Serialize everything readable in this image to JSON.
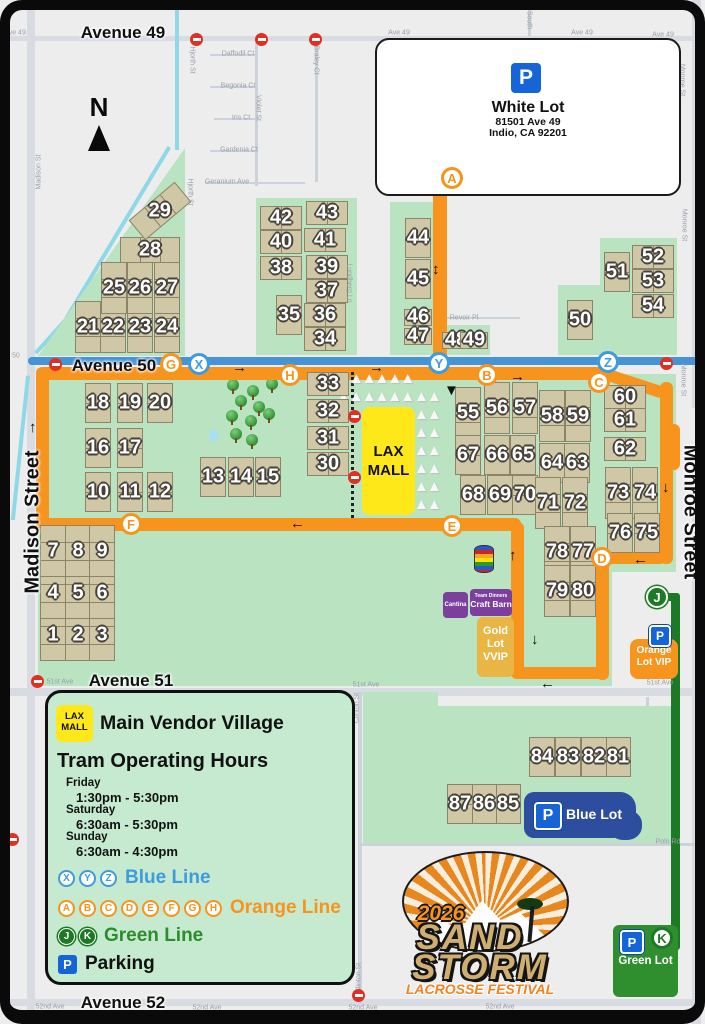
{
  "colors": {
    "blue_line": "#3f9be0",
    "orange_line": "#f7941e",
    "green_line": "#1d7a24",
    "parking_blue": "#1565d8",
    "blue_lot": "#2d4d9e",
    "green_lot": "#2f8f2f",
    "gold_lot": "#e9b545",
    "orange_lot": "#f7941e",
    "purple_venue": "#7d3f9e",
    "field_tan": "#cfc7a6",
    "festival_green": "#b9e3c1",
    "lax_yellow": "#ffe81a"
  },
  "north_label": "N",
  "marker_triangle": "▼",
  "tent_glyph": "▲",
  "white_lot": {
    "p": "P",
    "title": "White Lot",
    "line1": "81501 Ave 49",
    "line2": "Indio, CA 92201"
  },
  "lax_mall": {
    "line1": "LAX",
    "line2": "MALL"
  },
  "legend": {
    "lax1": "LAX",
    "lax2": "MALL",
    "vendor_title": "Main Vendor Village",
    "hours_title": "Tram Operating Hours",
    "schedule": [
      {
        "day": "Friday",
        "time": "1:30pm - 5:30pm"
      },
      {
        "day": "Saturday",
        "time": "6:30am - 5:30pm"
      },
      {
        "day": "Sunday",
        "time": "6:30am - 4:30pm"
      }
    ],
    "blue": {
      "stops": [
        "X",
        "Y",
        "Z"
      ],
      "label": "Blue Line"
    },
    "orange": {
      "stops": [
        "A",
        "B",
        "C",
        "D",
        "E",
        "F",
        "G",
        "H"
      ],
      "label": "Orange Line"
    },
    "green": {
      "stops": [
        "J",
        "K"
      ],
      "label": "Green Line"
    },
    "parking": {
      "icon": "P",
      "label": "Parking"
    }
  },
  "lots": {
    "blue": {
      "p": "P",
      "label": "Blue Lot"
    },
    "green": {
      "p": "P",
      "k": "K",
      "label": "Green Lot"
    },
    "orange": {
      "p": "P",
      "label1": "Orange",
      "label2": "Lot VIP"
    },
    "gold": {
      "label1": "Gold",
      "label2": "Lot",
      "label3": "VVIP"
    }
  },
  "venues": {
    "cantina": "Cantina",
    "craft_line1": "Team Dinners",
    "craft_line2": "Craft Barn"
  },
  "logo": {
    "year": "2026",
    "line1": "SAND",
    "line2": "STORM",
    "line3": "LACROSSE FESTIVAL"
  },
  "streets_large": [
    [
      "Avenue 49",
      123,
      33,
      0
    ],
    [
      "Avenue 50",
      114,
      366,
      0
    ],
    [
      "Avenue 51",
      131,
      681,
      0
    ],
    [
      "Avenue 52",
      123,
      1003,
      0
    ],
    [
      "Madison Street",
      33,
      522,
      -90
    ],
    [
      "Monroe Street",
      690,
      512,
      90
    ]
  ],
  "streets_small": [
    [
      "Ave 49",
      15,
      33,
      0
    ],
    [
      "Ave 49",
      399,
      33,
      0
    ],
    [
      "Ave 49",
      582,
      33,
      0
    ],
    [
      "Ave 49",
      663,
      35,
      0
    ],
    [
      "Hjorth St",
      192,
      60,
      90
    ],
    [
      "Hjorth St",
      190,
      192,
      90
    ],
    [
      "Daffodil Ct",
      238,
      54,
      0
    ],
    [
      "Begonia Ct",
      238,
      86,
      0
    ],
    [
      "Iris Ct",
      241,
      118,
      0
    ],
    [
      "Gardenia Ct",
      239,
      150,
      0
    ],
    [
      "Geranium Ave",
      227,
      182,
      0
    ],
    [
      "Violet St",
      258,
      108,
      90
    ],
    [
      "Braley Ct",
      316,
      60,
      90
    ],
    [
      "Madison St",
      39,
      172,
      -90
    ],
    [
      "Monroe St",
      682,
      80,
      90
    ],
    [
      "Monroe St",
      684,
      225,
      90
    ],
    [
      "Monroe St",
      683,
      380,
      90
    ],
    [
      "Lundberg Ln",
      349,
      283,
      90
    ],
    [
      "Revoir Pl",
      464,
      318,
      0
    ],
    [
      "e 50",
      13,
      356,
      0
    ],
    [
      "51st Ave",
      60,
      682,
      0
    ],
    [
      "51st Ave",
      366,
      685,
      0
    ],
    [
      "51st Ave",
      660,
      683,
      0
    ],
    [
      "Clinton St",
      357,
      708,
      -90
    ],
    [
      "Clinton St",
      359,
      978,
      -90
    ],
    [
      "Polo Rd",
      668,
      842,
      0
    ],
    [
      "52nd Ave",
      50,
      1007,
      0
    ],
    [
      "52nd Ave",
      207,
      1008,
      0
    ],
    [
      "52nd Ave",
      363,
      1008,
      0
    ],
    [
      "52nd Ave",
      500,
      1007,
      0
    ],
    [
      "South",
      529,
      20,
      90
    ]
  ],
  "fields": [
    [
      1,
      53,
      635,
      "v3"
    ],
    [
      2,
      78,
      635,
      "v3"
    ],
    [
      3,
      102,
      635,
      "v3"
    ],
    [
      4,
      53,
      593,
      "v3"
    ],
    [
      5,
      78,
      593,
      "v3"
    ],
    [
      6,
      102,
      593,
      "v3"
    ],
    [
      7,
      53,
      551,
      "v3"
    ],
    [
      8,
      78,
      551,
      "v3"
    ],
    [
      9,
      102,
      551,
      "v3"
    ],
    [
      10,
      98,
      492,
      "v2"
    ],
    [
      11,
      130,
      492,
      "v2"
    ],
    [
      12,
      160,
      492,
      "v2"
    ],
    [
      13,
      213,
      477,
      "v2"
    ],
    [
      14,
      241,
      477,
      "v2"
    ],
    [
      15,
      268,
      477,
      "v2"
    ],
    [
      16,
      98,
      448,
      "v2"
    ],
    [
      17,
      130,
      448,
      "v2"
    ],
    [
      18,
      98,
      403,
      "v2"
    ],
    [
      19,
      130,
      403,
      "v2"
    ],
    [
      20,
      160,
      403,
      "v2"
    ],
    [
      21,
      88,
      327,
      "v3"
    ],
    [
      22,
      113,
      327,
      "v3"
    ],
    [
      23,
      140,
      327,
      "v3"
    ],
    [
      24,
      167,
      327,
      "v3"
    ],
    [
      25,
      114,
      288,
      "v3"
    ],
    [
      26,
      140,
      288,
      "v3"
    ],
    [
      27,
      167,
      288,
      "v3"
    ],
    [
      28,
      150,
      250,
      "h3"
    ],
    [
      29,
      160,
      211,
      "h3",
      -40
    ],
    [
      30,
      328,
      464,
      "h2"
    ],
    [
      31,
      328,
      438,
      "h2"
    ],
    [
      32,
      328,
      411,
      "h2"
    ],
    [
      33,
      328,
      384,
      "h2"
    ],
    [
      34,
      325,
      339,
      "h2"
    ],
    [
      35,
      289,
      315,
      "v2"
    ],
    [
      36,
      325,
      315,
      "h2"
    ],
    [
      37,
      327,
      291,
      "h2"
    ],
    [
      38,
      281,
      268,
      "h2"
    ],
    [
      39,
      327,
      267,
      "h2"
    ],
    [
      40,
      281,
      242,
      "h2"
    ],
    [
      41,
      325,
      240,
      "h2"
    ],
    [
      42,
      281,
      218,
      "h2"
    ],
    [
      43,
      327,
      213,
      "h2"
    ],
    [
      44,
      418,
      238,
      "v2"
    ],
    [
      45,
      418,
      279,
      "v2"
    ],
    [
      46,
      418,
      317,
      "s"
    ],
    [
      47,
      418,
      336,
      "s"
    ],
    [
      48,
      456,
      340,
      "s"
    ],
    [
      49,
      474,
      340,
      "s"
    ],
    [
      50,
      580,
      320,
      "v2"
    ],
    [
      51,
      617,
      272,
      "v2"
    ],
    [
      52,
      653,
      257,
      "h2"
    ],
    [
      53,
      653,
      281,
      "h2"
    ],
    [
      54,
      653,
      306,
      "h2"
    ],
    [
      55,
      468,
      413,
      "v3"
    ],
    [
      56,
      497,
      408,
      "v3"
    ],
    [
      57,
      525,
      408,
      "v3"
    ],
    [
      58,
      552,
      416,
      "v3"
    ],
    [
      59,
      578,
      416,
      "v3"
    ],
    [
      60,
      625,
      397,
      "h2"
    ],
    [
      61,
      625,
      420,
      "h2"
    ],
    [
      62,
      625,
      449,
      "h2"
    ],
    [
      63,
      577,
      463,
      "v2"
    ],
    [
      64,
      552,
      463,
      "v2"
    ],
    [
      65,
      523,
      455,
      "v2"
    ],
    [
      66,
      497,
      455,
      "v2"
    ],
    [
      67,
      468,
      455,
      "v2"
    ],
    [
      68,
      473,
      495,
      "v2"
    ],
    [
      69,
      500,
      495,
      "v2"
    ],
    [
      70,
      525,
      495,
      "v2"
    ],
    [
      71,
      548,
      503,
      "v3"
    ],
    [
      72,
      575,
      503,
      "v3"
    ],
    [
      73,
      618,
      493,
      "v3"
    ],
    [
      74,
      645,
      493,
      "v3"
    ],
    [
      75,
      647,
      533,
      "v2"
    ],
    [
      76,
      620,
      533,
      "v2"
    ],
    [
      77,
      583,
      552,
      "v3"
    ],
    [
      78,
      557,
      552,
      "v3"
    ],
    [
      79,
      557,
      591,
      "v3"
    ],
    [
      80,
      583,
      591,
      "v3"
    ],
    [
      81,
      618,
      757,
      "v2"
    ],
    [
      82,
      594,
      757,
      "v2"
    ],
    [
      83,
      568,
      757,
      "v2"
    ],
    [
      84,
      542,
      757,
      "v2"
    ],
    [
      85,
      508,
      804,
      "v2"
    ],
    [
      86,
      484,
      804,
      "v2"
    ],
    [
      87,
      460,
      804,
      "v2"
    ]
  ],
  "stops": [
    [
      "A",
      452,
      178,
      "o"
    ],
    [
      "B",
      487,
      375,
      "o"
    ],
    [
      "C",
      599,
      382,
      "o"
    ],
    [
      "D",
      602,
      558,
      "o"
    ],
    [
      "E",
      452,
      526,
      "o"
    ],
    [
      "F",
      131,
      524,
      "o"
    ],
    [
      "G",
      171,
      364,
      "o"
    ],
    [
      "H",
      290,
      375,
      "o"
    ],
    [
      "X",
      199,
      364,
      "b"
    ],
    [
      "Y",
      439,
      363,
      "b"
    ],
    [
      "Z",
      608,
      362,
      "b"
    ],
    [
      "J",
      657,
      597,
      "g"
    ],
    [
      "K",
      662,
      938,
      "gk"
    ]
  ],
  "arrows": [
    [
      240,
      368,
      "→"
    ],
    [
      377,
      368,
      "→"
    ],
    [
      518,
      377,
      "→"
    ],
    [
      298,
      524,
      "←"
    ],
    [
      37,
      428,
      "↑"
    ],
    [
      440,
      270,
      "↕"
    ],
    [
      670,
      488,
      "↓"
    ],
    [
      641,
      560,
      "←"
    ],
    [
      517,
      556,
      "↑"
    ],
    [
      539,
      640,
      "↓"
    ],
    [
      548,
      684,
      "←"
    ]
  ],
  "no_entry": [
    [
      196,
      39
    ],
    [
      261,
      39
    ],
    [
      315,
      39
    ],
    [
      55,
      364
    ],
    [
      666,
      363
    ],
    [
      354,
      416
    ],
    [
      354,
      477
    ],
    [
      37,
      681
    ],
    [
      12,
      839
    ],
    [
      358,
      995
    ]
  ],
  "trees": [
    [
      233,
      385
    ],
    [
      253,
      391
    ],
    [
      272,
      384
    ],
    [
      241,
      401
    ],
    [
      259,
      407
    ],
    [
      232,
      416
    ],
    [
      251,
      421
    ],
    [
      269,
      414
    ],
    [
      236,
      434
    ],
    [
      252,
      440
    ]
  ]
}
